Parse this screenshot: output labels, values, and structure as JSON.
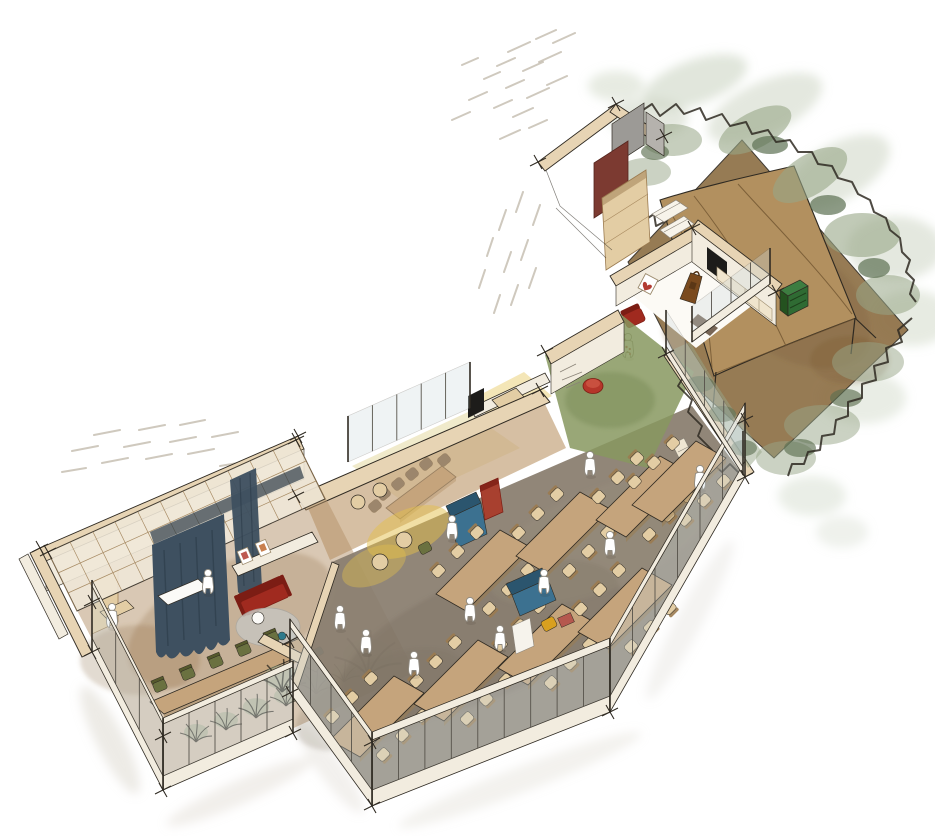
{
  "illustration": {
    "kind": "hand-drawn axonometric cutaway sketch",
    "subject": "office interior with garden terrace, work hall, meeting rooms and multipurpose wing",
    "visible_text": []
  },
  "palette": {
    "paper": "#ffffff",
    "pencil": "#b6ad9c",
    "ink": "#2f2a22",
    "wall-face": "#f2ecdf",
    "wall-top": "#e7d4b4",
    "wood-light": "#e3cda4",
    "wood-mid": "#c5a47c",
    "wood-dark": "#9b7b50",
    "floor-hall": "#8b8071",
    "floor-wing": "#b3926a",
    "garden-ground": "#8e7046",
    "tent": "#b2905f",
    "grass": "#87985f",
    "yellow": "#e3c04b",
    "green-chair": "#6a7140",
    "green-crate": "#2f6b33",
    "foliage-light": "#c9d2bf",
    "foliage-mid": "#97a687",
    "foliage-dark": "#5d7052",
    "curtain": "#3e5060",
    "curtain-dark": "#2c3b47",
    "red-sofa": "#a02a1f",
    "red-dark": "#7c1d14",
    "maroon": "#7c3a31",
    "heart": "#b23c33",
    "blue-sofa": "#3c7190",
    "blue-dark": "#2b556e",
    "teal": "#2e7a8c",
    "glass": "#ccd9dd",
    "grey-wall": "#9c9a96",
    "grey-light": "#b5b2ad",
    "rug": "#c6c4bd",
    "tv": "#1d1c1a",
    "figure": "#8f8a80",
    "pouf": "#b5362a",
    "ochre": "#d9a01f",
    "shadow": "#cfcabd",
    "accent-red-table": "#b5584e"
  },
  "hall": {
    "label": "open work hall with long tables",
    "tables": [
      [
        330,
        740
      ],
      [
        414,
        704
      ],
      [
        498,
        668
      ],
      [
        578,
        632
      ],
      [
        436,
        594
      ],
      [
        516,
        556
      ],
      [
        596,
        520
      ],
      [
        632,
        505
      ]
    ]
  },
  "figures": [
    [
      340,
      622
    ],
    [
      366,
      646
    ],
    [
      414,
      668
    ],
    [
      470,
      614
    ],
    [
      544,
      586
    ],
    [
      610,
      548
    ],
    [
      500,
      642
    ],
    [
      590,
      468
    ],
    [
      208,
      586
    ],
    [
      112,
      620
    ],
    [
      700,
      482
    ],
    [
      452,
      532
    ]
  ],
  "corner_ticks": [
    [
      296,
      496
    ],
    [
      540,
      390
    ],
    [
      40,
      548
    ],
    [
      298,
      436
    ],
    [
      92,
      652
    ],
    [
      163,
      790
    ],
    [
      293,
      733
    ],
    [
      290,
      693
    ],
    [
      372,
      806
    ],
    [
      610,
      712
    ],
    [
      745,
      477
    ],
    [
      538,
      162
    ],
    [
      616,
      104
    ],
    [
      664,
      136
    ],
    [
      545,
      352
    ],
    [
      692,
      228
    ],
    [
      776,
      292
    ],
    [
      290,
      641
    ],
    [
      372,
      742
    ],
    [
      745,
      420
    ],
    [
      163,
      736
    ],
    [
      92,
      602
    ],
    [
      48,
      552
    ],
    [
      296,
      440
    ],
    [
      666,
      354
    ]
  ],
  "facades": [
    {
      "id": "facade-hall-front",
      "base": [
        372,
        806,
        610,
        712
      ],
      "parapet": 16,
      "glass": 50,
      "fascia": 8,
      "mullions": 9
    },
    {
      "id": "facade-hall-east",
      "base": [
        610,
        712,
        745,
        477
      ],
      "parapet": 16,
      "glass": 50,
      "fascia": 8,
      "mullions": 6
    },
    {
      "id": "facade-hall-west",
      "base": [
        290,
        693,
        372,
        806
      ],
      "parapet": 16,
      "glass": 50,
      "fascia": 8,
      "mullions": 4
    },
    {
      "id": "facade-wing-front",
      "base": [
        163,
        790,
        293,
        733
      ],
      "parapet": 14,
      "glass": 52,
      "fascia": 6,
      "mullions": 5
    },
    {
      "id": "facade-wing-west",
      "base": [
        92,
        652,
        163,
        790
      ],
      "parapet": 14,
      "glass": 52,
      "fascia": 6,
      "mullions": 3
    },
    {
      "id": "window-lounge-terrace",
      "base": [
        692,
        342,
        770,
        284
      ],
      "parapet": 10,
      "glass": 26,
      "fascia": 0,
      "mullions": 4
    },
    {
      "id": "window-hall-garden",
      "base": [
        666,
        354,
        743,
        475
      ],
      "parapet": 8,
      "glass": 36,
      "fascia": 0,
      "mullions": 4
    },
    {
      "id": "glass-meeting-room",
      "base": [
        348,
        462,
        470,
        408
      ],
      "parapet": 0,
      "glass": 46,
      "fascia": 0,
      "mullions": 5
    }
  ],
  "hatching": {
    "segments": [
      [
        575,
        33,
        553,
        43
      ],
      [
        556,
        30,
        536,
        39
      ],
      [
        530,
        42,
        508,
        52
      ],
      [
        561,
        52,
        539,
        62
      ],
      [
        543,
        62,
        523,
        71
      ],
      [
        515,
        58,
        497,
        66
      ],
      [
        567,
        76,
        547,
        85
      ],
      [
        549,
        88,
        527,
        98
      ],
      [
        524,
        80,
        506,
        88
      ],
      [
        500,
        72,
        484,
        79
      ],
      [
        533,
        108,
        513,
        117
      ],
      [
        512,
        100,
        494,
        108
      ],
      [
        487,
        92,
        469,
        100
      ],
      [
        547,
        120,
        529,
        128
      ],
      [
        520,
        130,
        500,
        139
      ],
      [
        478,
        58,
        462,
        65
      ],
      [
        470,
        112,
        452,
        120
      ],
      [
        523,
        192,
        516,
        212
      ],
      [
        540,
        205,
        533,
        225
      ],
      [
        506,
        210,
        499,
        230
      ],
      [
        528,
        240,
        521,
        260
      ],
      [
        511,
        252,
        504,
        272
      ],
      [
        493,
        238,
        487,
        256
      ],
      [
        536,
        268,
        529,
        288
      ],
      [
        518,
        285,
        511,
        305
      ],
      [
        500,
        295,
        494,
        313
      ],
      [
        485,
        270,
        479,
        288
      ],
      [
        120,
        430,
        94,
        435
      ],
      [
        165,
        425,
        139,
        430
      ],
      [
        205,
        420,
        180,
        425
      ],
      [
        98,
        446,
        72,
        451
      ],
      [
        150,
        442,
        124,
        447
      ],
      [
        196,
        437,
        170,
        442
      ],
      [
        238,
        432,
        212,
        437
      ],
      [
        128,
        458,
        102,
        463
      ],
      [
        172,
        454,
        146,
        459
      ],
      [
        214,
        449,
        188,
        454
      ],
      [
        86,
        468,
        62,
        472
      ],
      [
        244,
        462,
        220,
        466
      ]
    ]
  }
}
